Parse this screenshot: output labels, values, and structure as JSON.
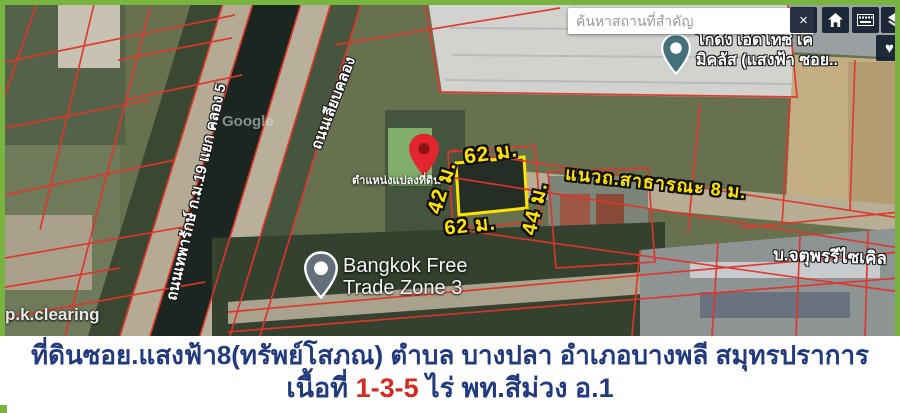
{
  "colors": {
    "frame_green": "#79b53e",
    "caption_text": "#223a7e",
    "caption_highlight": "#d42a22",
    "measure_yellow": "#ffe300",
    "parcel_line_red": "#e0352b"
  },
  "map": {
    "search": {
      "placeholder": "ค้นหาสถานที่สำคัญ"
    },
    "toolbar": {
      "close_glyph": "×",
      "heart_glyph": "♥"
    },
    "poi": {
      "warehouse_line1": "โกดัง เอ็ดโทซี เค",
      "warehouse_line2": "มิคลัส (แสงฟ้า ซอย..",
      "trade_zone_line1": "Bangkok Free",
      "trade_zone_line2": "Trade Zone 3",
      "recycle": "บ.จตุพรรีไซเคิล",
      "clearing": "p.k.clearing",
      "watermark": "Google"
    },
    "roads": {
      "left_road": "ถนนเทพารักษ์ ก.ม.19 แยก คลอง 5",
      "canal_road": "ถนนเลียบคลอง",
      "public_road": "แนวถ.สาธารณะ 8 ม."
    },
    "plot": {
      "location_label": "ตำแหน่งแปลงที่ดิน",
      "width_top": "62 ม.",
      "side_left": "42 ม.",
      "side_right": "44 ม.",
      "width_bottom": "62 ม."
    }
  },
  "caption": {
    "line1": "ที่ดินซอย.แสงฟ้า8(ทรัพย์โสภณ) ตำบล บางปลา อำเภอบางพลี สมุทรปราการ",
    "line2_prefix": "เนื้อที่ ",
    "line2_area": "1-3-5",
    "line2_suffix": " ไร่  พท.สีม่วง อ.1"
  }
}
